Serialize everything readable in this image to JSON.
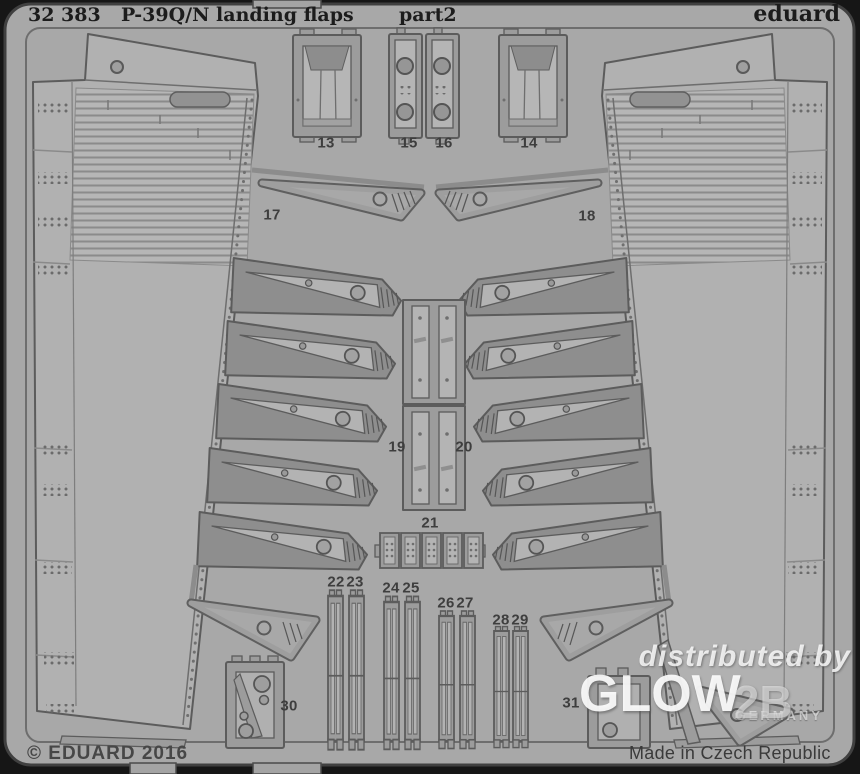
{
  "header": {
    "catalog_number": "32 383",
    "title": "P-39Q/N landing flaps",
    "part_suffix": "part2",
    "brand": "eduard"
  },
  "part_labels": {
    "p13": "13",
    "p14": "14",
    "p15": "15",
    "p16": "16",
    "p17": "17",
    "p18": "18",
    "p19": "19",
    "p20": "20",
    "p21": "21",
    "p22": "22",
    "p23": "23",
    "p24": "24",
    "p25": "25",
    "p26": "26",
    "p27": "27",
    "p28": "28",
    "p29": "29",
    "p30": "30",
    "p31": "31"
  },
  "watermark": {
    "prefix": "distributed by",
    "brand": "GLOW",
    "brand_suffix": "2B",
    "country": "Germany"
  },
  "footer": {
    "copyright": "© EDUARD 2016",
    "made_in": "Made in Czech Republic"
  },
  "colors": {
    "plate": "#a8a8a8",
    "background_frame": "#161616",
    "part_dark": "#8e8e8e",
    "part_light": "#b5b5b5",
    "outline": "#5c5c5c",
    "label_text": "#3e3e3e",
    "header_text": "#1c1c1c",
    "watermark_white": "#ffffff"
  }
}
